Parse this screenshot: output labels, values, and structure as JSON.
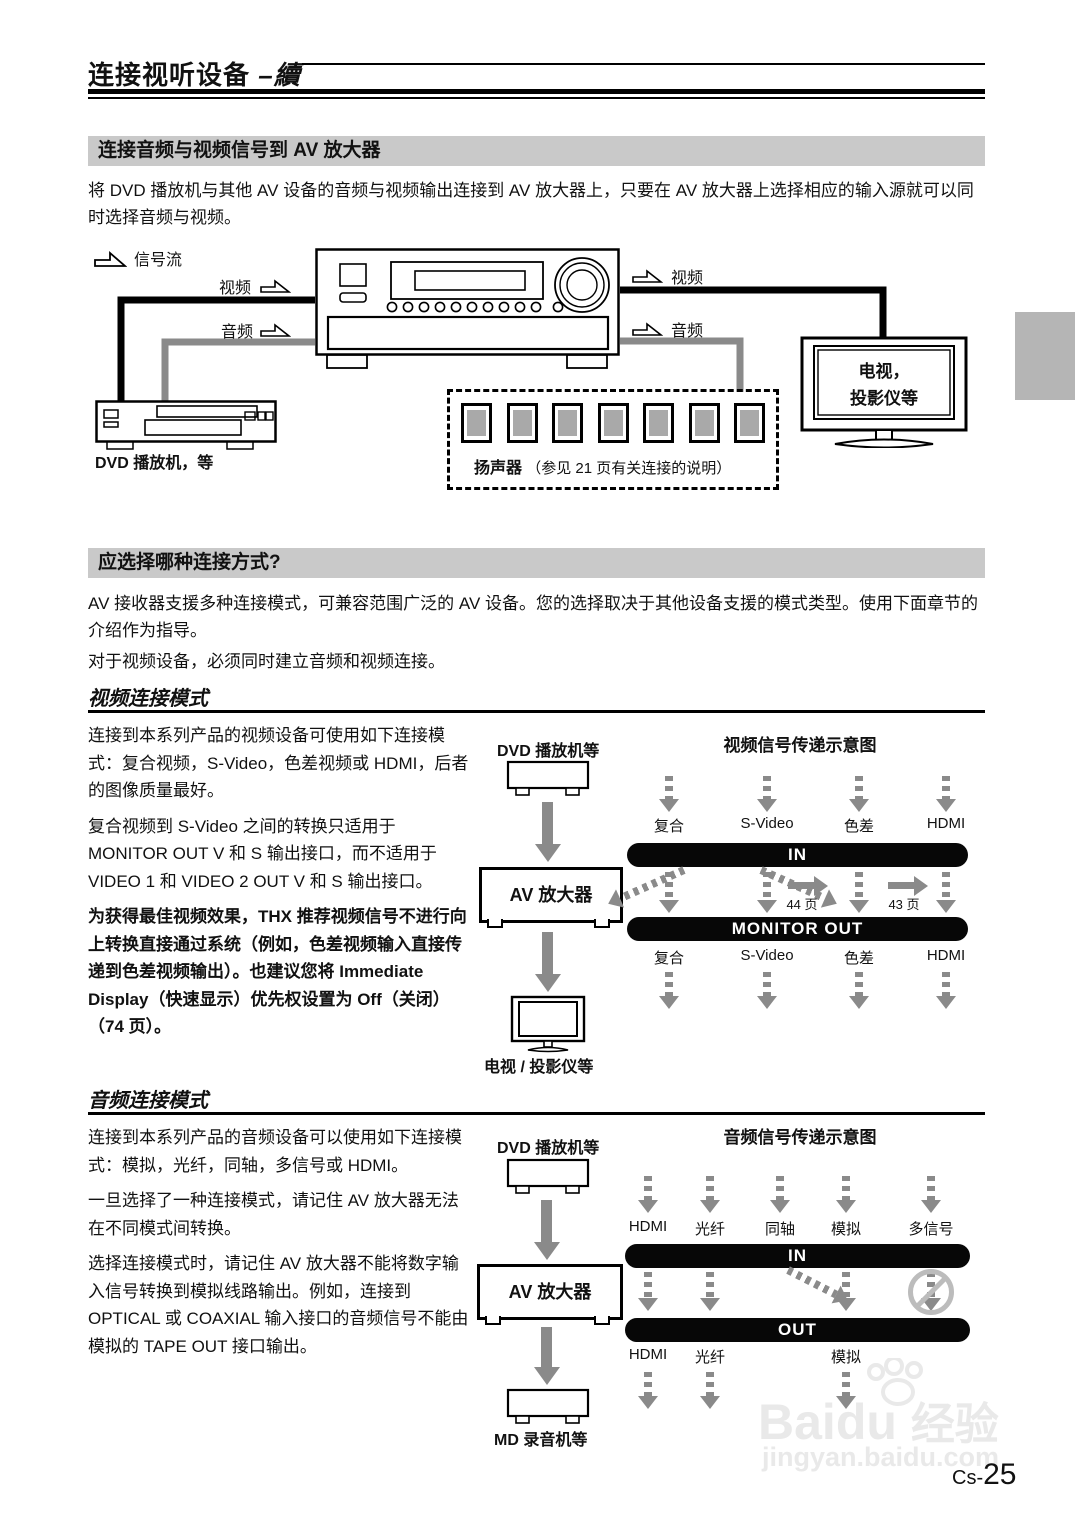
{
  "page": {
    "title": "连接视听设备",
    "title_suffix": "–續",
    "page_number_prefix": "Cs-",
    "page_number": "25"
  },
  "colors": {
    "section_header_bg": "#c9c9c9",
    "arrow_gray": "#8a8a8a",
    "speaker_gray": "#a9a9a9",
    "bar_black": "#070707",
    "edge_tab_gray": "#b5b5b5",
    "watermark_gray": "#e9e9e9"
  },
  "section1": {
    "heading": "连接音频与视频信号到 AV 放大器",
    "intro": "将 DVD 播放机与其他 AV 设备的音频与视频输出连接到 AV 放大器上，只要在 AV 放大器上选择相应的输入源就可以同时选择音频与视频。"
  },
  "diagram1": {
    "legend": "信号流",
    "video_left": "视频",
    "audio_left": "音频",
    "video_right": "视频",
    "audio_right": "音频",
    "dvd_label": "DVD 播放机，等",
    "tv_line1": "电视，",
    "tv_line2": "投影仪等",
    "speakers_label": "扬声器",
    "speakers_note": "（参见 21 页有关连接的说明）"
  },
  "section2": {
    "heading": "应选择哪种连接方式?",
    "para1": "AV 接收器支援多种连接模式，可兼容范围广泛的 AV 设备。您的选择取决于其他设备支援的模式类型。使用下面章节的介绍作为指导。",
    "para2": "对于视频设备，必须同时建立音频和视频连接。"
  },
  "video_section": {
    "heading": "视频连接模式",
    "para1": "连接到本系列产品的视频设备可使用如下连接模式：复合视频，S-Video，色差视频或 HDMI，后者的图像质量最好。",
    "para2": "复合视频到 S-Video 之间的转换只适用于 MONITOR OUT V 和 S 输出接口，而不适用于 VIDEO 1 和 VIDEO 2 OUT V 和 S 输出接口。",
    "para3": "为获得最佳视频效果，THX 推荐视频信号不进行向上转换直接通过系统（例如，色差视频输入直接传递到色差视频输出）。也建议您将 Immediate Display（快速显示）优先权设置为 Off（关闭）（74 页）。",
    "chain": {
      "source": "DVD 播放机等",
      "amp": "AV 放大器",
      "sink": "电视 / 投影仪等"
    },
    "flow": {
      "title": "视频信号传递示意图",
      "in_label": "IN",
      "out_label": "MONITOR OUT",
      "columns": [
        "复合",
        "S-Video",
        "色差",
        "HDMI"
      ],
      "page_ref1": "44 页",
      "page_ref2": "43 页"
    }
  },
  "audio_section": {
    "heading": "音频连接模式",
    "para1": "连接到本系列产品的音频设备可以使用如下连接模式：模拟，光纤，同轴，多信号或 HDMI。",
    "para2": "一旦选择了一种连接模式，请记住 AV 放大器无法在不同模式间转换。",
    "para3": "选择连接模式时，请记住 AV 放大器不能将数字输入信号转换到模拟线路输出。例如，连接到 OPTICAL 或 COAXIAL 输入接口的音频信号不能由模拟的 TAPE OUT 接口输出。",
    "chain": {
      "source": "DVD 播放机等",
      "amp": "AV 放大器",
      "sink": "MD 录音机等"
    },
    "flow": {
      "title": "音频信号传递示意图",
      "in_label": "IN",
      "out_label": "OUT",
      "columns_in": [
        "HDMI",
        "光纤",
        "同轴",
        "模拟",
        "多信号"
      ],
      "columns_out": [
        "HDMI",
        "光纤",
        "模拟"
      ]
    }
  },
  "watermark": {
    "line1_a": "Bai",
    "line1_b": "du",
    "line1_c": "经验",
    "line2": "jingyan.baidu.com"
  }
}
